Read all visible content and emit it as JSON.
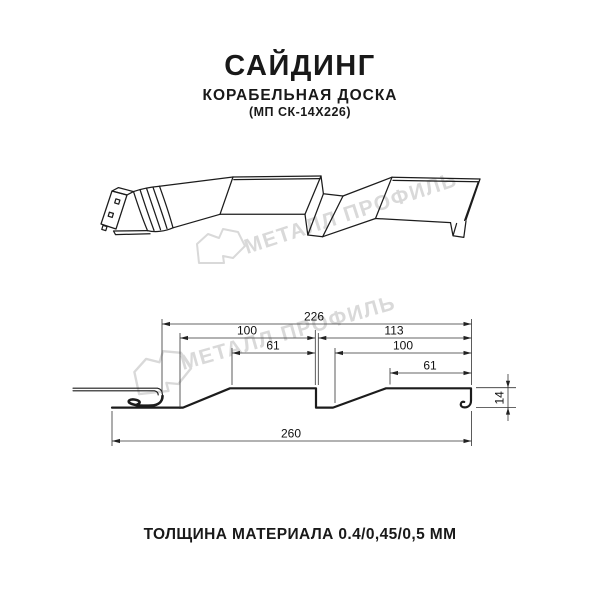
{
  "header": {
    "title": "САЙДИНГ",
    "subtitle": "КОРАБЕЛЬНАЯ ДОСКА",
    "model": "(МП СК-14Х226)"
  },
  "watermark": {
    "brand": "МЕТАЛЛ ПРОФИЛЬ",
    "color": "#d9d9d9"
  },
  "section": {
    "dims": {
      "overall_top": "226",
      "board1_width": "100",
      "board2_width": "113",
      "board1_flat": "61",
      "board2_inner": "100",
      "board2_flat": "61",
      "overall_bottom": "260",
      "height": "14"
    }
  },
  "footer": {
    "thickness": "ТОЛЩИНА МАТЕРИАЛА 0.4/0,45/0,5 ММ"
  }
}
